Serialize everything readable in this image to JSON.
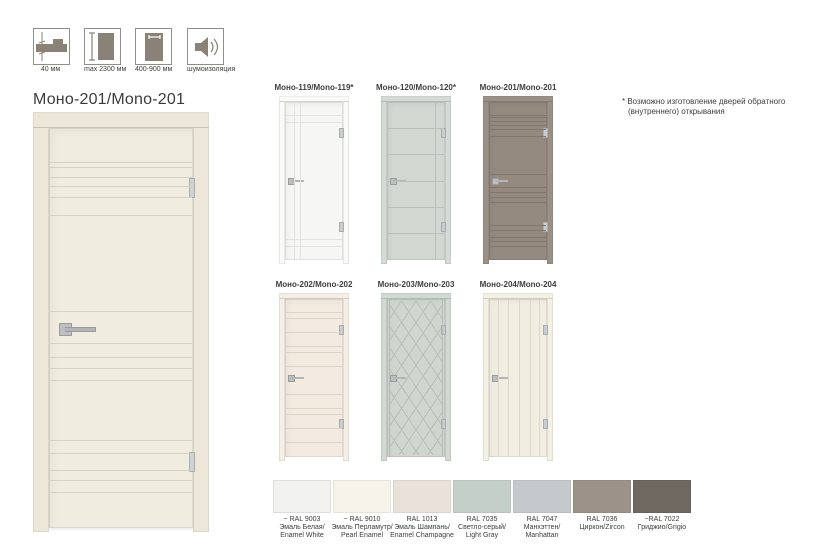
{
  "spec_icons": [
    {
      "label": "40 мм"
    },
    {
      "label": "max 2300 мм"
    },
    {
      "label": "400-900 мм"
    },
    {
      "label": "шумоизоляция"
    }
  ],
  "main_door": {
    "title": "Моно-201/Mono-201",
    "frame": "#ece7d8",
    "leaf": "#f0ecdf",
    "line": "#d6d1c1"
  },
  "note": {
    "line1": "* Возможно изготовление дверей обратного",
    "line2": "(внутреннего) открывания"
  },
  "doors": [
    {
      "label": "Моно-119/Mono-119*",
      "frame": "#fafaf9",
      "leaf": "#f6f6f5",
      "line": "#e2e2e1"
    },
    {
      "label": "Моно-120/Mono-120*",
      "frame": "#d4dbd5",
      "leaf": "#d1d8d2",
      "line": "#b9c0ba"
    },
    {
      "label": "Моно-201/Mono-201",
      "frame": "#9a9085",
      "leaf": "#948a80",
      "line": "#7f766c"
    },
    {
      "label": "Моно-202/Mono-202",
      "frame": "#f5eee5",
      "leaf": "#f3ebe1",
      "line": "#dcd3c5"
    },
    {
      "label": "Моно-203/Mono-203",
      "frame": "#d2d9d3",
      "leaf": "#cfd6d0",
      "line": "#b6bdb7"
    },
    {
      "label": "Моно-204/Mono-204",
      "frame": "#f3f0e4",
      "leaf": "#f1eee1",
      "line": "#dcd7c7"
    }
  ],
  "swatches": [
    {
      "ral": "~ RAL 9003",
      "ru": "Эмаль Белая/",
      "en": "Enamel White",
      "color": "#f2f2f1"
    },
    {
      "ral": "~ RAL 9010",
      "ru": "Эмаль Перламутр/",
      "en": "Pearl Enamel",
      "color": "#f6f3ea"
    },
    {
      "ral": "RAL 1013",
      "ru": "Эмаль Шампань/",
      "en": "Enamel Champagne",
      "color": "#ebe1db"
    },
    {
      "ral": "RAL 7035",
      "ru": "Светло-серый/",
      "en": "Light Gray",
      "color": "#c5cfc9"
    },
    {
      "ral": "RAL 7047",
      "ru": "Манхэттен/",
      "en": "Manhattan",
      "color": "#c6c9cb"
    },
    {
      "ral": "RAL 7036",
      "ru": "Циркон/Zircon",
      "en": "",
      "color": "#9c9289"
    },
    {
      "ral": "~RAL 7022",
      "ru": "Гриджио/Grigio",
      "en": "",
      "color": "#6f6861"
    }
  ]
}
